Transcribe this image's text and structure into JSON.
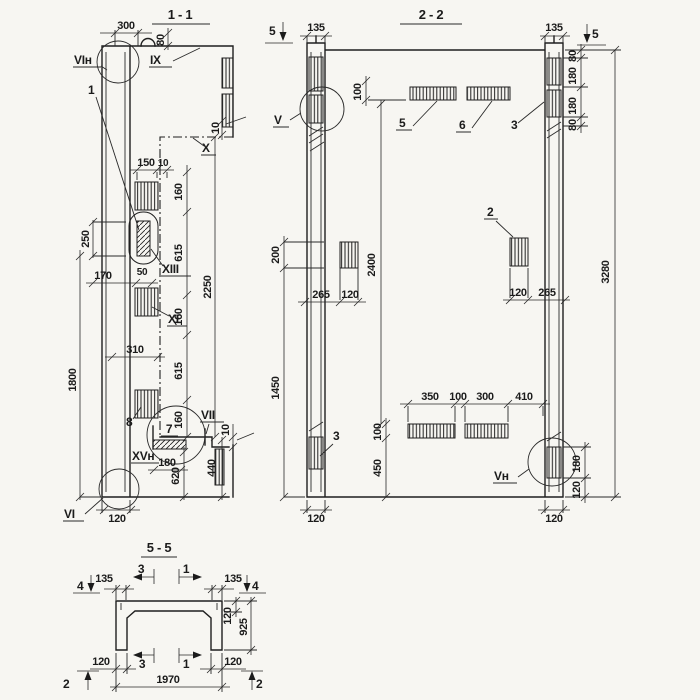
{
  "s11": {
    "title": "1 - 1",
    "dims": {
      "d300": "300",
      "d80": "80",
      "d10t": "10",
      "d150": "150",
      "d10s": "10",
      "d160a": "160",
      "d615a": "615",
      "d160b": "160",
      "d615b": "615",
      "d160c": "160",
      "d2250": "2250",
      "d250": "250",
      "d170": "170",
      "d50": "50",
      "d310": "310",
      "d1800": "1800",
      "d10b": "10",
      "d440": "440",
      "d180": "180",
      "d620": "620",
      "d120": "120"
    },
    "labels": {
      "vin": "VIн",
      "one": "1",
      "ix": "IX",
      "x": "X",
      "xiii": "XIII",
      "xi": "XI",
      "eight": "8",
      "seven": "7",
      "vii": "VII",
      "xvn": "XVн",
      "vi": "VI"
    }
  },
  "s22": {
    "title": "2 - 2",
    "dims": {
      "d135l": "135",
      "d135r": "135",
      "d100t": "100",
      "d80a": "80",
      "d180a": "180",
      "d180b": "180",
      "d80b": "80",
      "d3280": "3280",
      "d200": "200",
      "d2400": "2400",
      "d265l": "265",
      "d120pl": "120",
      "d120pr": "120",
      "d265r": "265",
      "d1450": "1450",
      "d350": "350",
      "d100m": "100",
      "d300": "300",
      "d410": "410",
      "d100b": "100",
      "d450": "450",
      "d180rc": "180",
      "d120rc": "120",
      "d120wl": "120",
      "d120wr": "120"
    },
    "labels": {
      "v": "V",
      "vn": "Vн",
      "p2": "2",
      "p3t": "3",
      "p3b": "3",
      "p5": "5",
      "p6": "6",
      "m5l": "5",
      "m5r": "5"
    }
  },
  "s55": {
    "title": "5 - 5",
    "dims": {
      "d135l": "135",
      "d135r": "135",
      "d120f": "120",
      "d925": "925",
      "d120bl": "120",
      "d120br": "120",
      "d1970": "1970"
    },
    "markers": {
      "m4l": "4",
      "m4r": "4",
      "m3t": "3",
      "m1t": "1",
      "m3b": "3",
      "m1b": "1",
      "m2l": "2",
      "m2r": "2"
    }
  }
}
